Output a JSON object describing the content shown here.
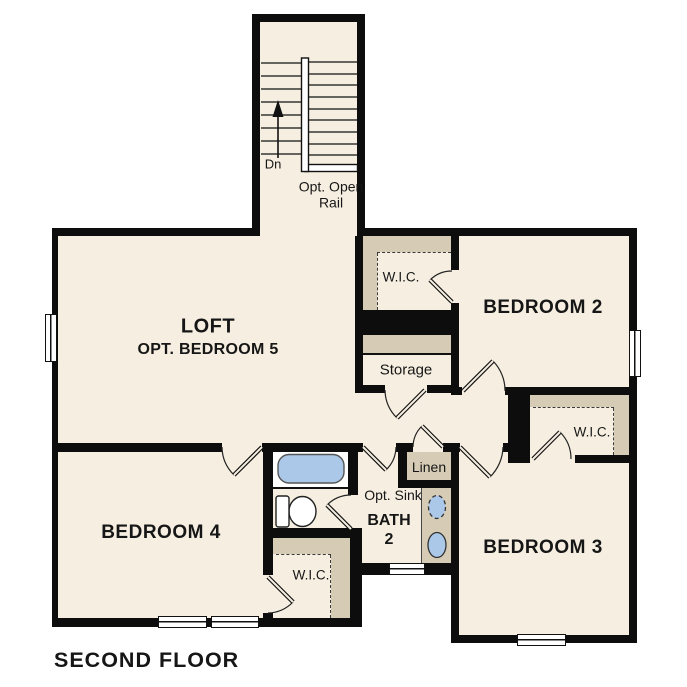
{
  "title": "SECOND FLOOR",
  "rooms": {
    "loft": {
      "name": "LOFT",
      "option": "OPT. BEDROOM 5"
    },
    "bedroom2": {
      "name": "BEDROOM 2"
    },
    "bedroom3": {
      "name": "BEDROOM 3"
    },
    "bedroom4": {
      "name": "BEDROOM 4"
    },
    "bath2": {
      "name": "BATH",
      "number": "2",
      "opt_sink": "Opt. Sink"
    },
    "storage": {
      "name": "Storage"
    },
    "linen": {
      "name": "Linen"
    },
    "wic_bedroom2": {
      "name": "W.I.C."
    },
    "wic_bedroom3": {
      "name": "W.I.C."
    },
    "wic_bedroom4": {
      "name": "W.I.C."
    }
  },
  "stairs": {
    "direction_label": "Dn",
    "rail_note_line1": "Opt. Open",
    "rail_note_line2": "Rail"
  },
  "colors": {
    "floor": "#f6efe1",
    "wall": "#0d0d0d",
    "shelving": "#d6ccb6",
    "fixture_blue": "#abc8e8",
    "outside": "#ffffff"
  }
}
